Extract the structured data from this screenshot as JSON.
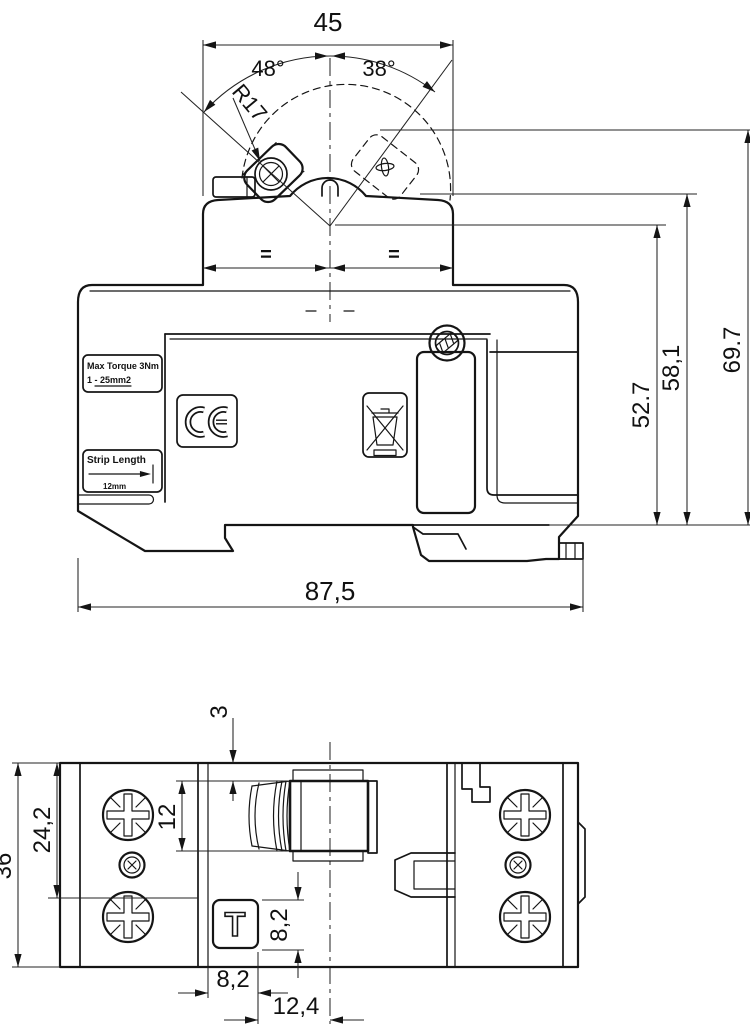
{
  "side_view": {
    "dims": {
      "width_top": "45",
      "angle_left": "48°",
      "angle_right": "38°",
      "lever_radius": "R17",
      "equal_left": "=",
      "equal_right": "=",
      "height_1": "52.7",
      "height_2": "58,1",
      "height_3": "69.7",
      "width_overall": "87,5"
    },
    "labels": {
      "max_torque_line1": "Max Torque 3Nm",
      "max_torque_line2": "1 - 25mm2",
      "strip_length_title": "Strip Length",
      "strip_length_value": "12mm"
    },
    "marks": {
      "ce": "CE",
      "weee": "crossed-out wheelie bin"
    }
  },
  "bottom_view": {
    "dims": {
      "height_overall": "36",
      "screw_row_offset": "24,2",
      "terminal_height": "12",
      "terminal_top_offset": "3",
      "test_button_height": "8,2",
      "test_button_width": "8,2",
      "button_to_center": "12,4"
    },
    "test_button_label": "T"
  }
}
